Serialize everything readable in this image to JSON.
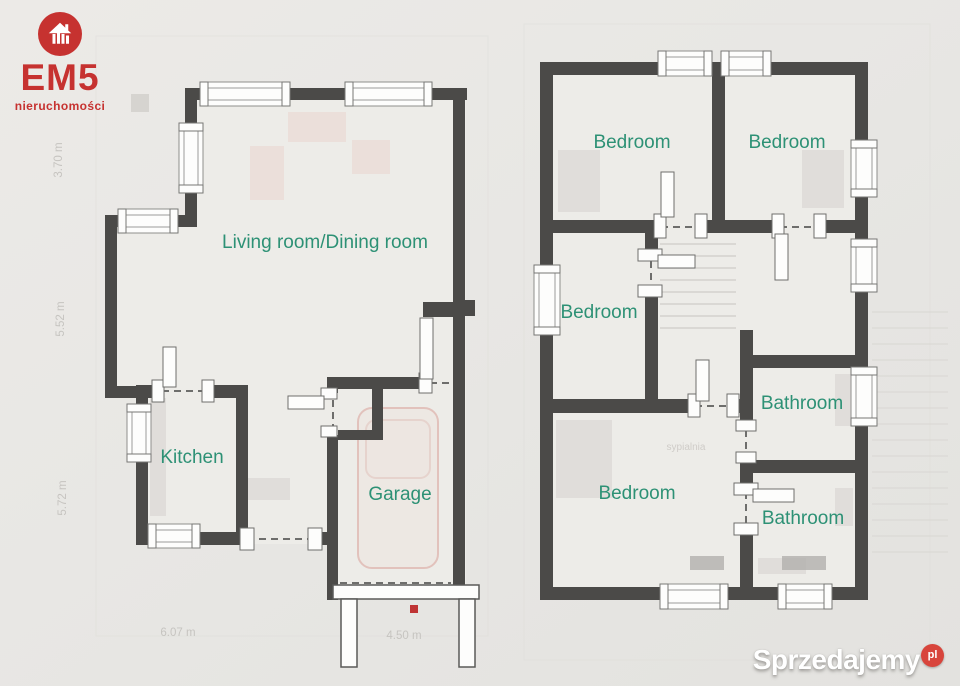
{
  "branding": {
    "logo_text": "EM5",
    "logo_subtext": "nieruchomości",
    "watermark_text": "Sprzedajemy",
    "watermark_tld": "pl"
  },
  "colors": {
    "wall": "#4b4a48",
    "room_label": "#2d9175",
    "brand_red": "#c63230",
    "watermark_red": "#d8453c",
    "accent_dot": "#bf3434"
  },
  "ground_floor": {
    "rooms": [
      {
        "label": "Living room/Dining room"
      },
      {
        "label": "Kitchen"
      },
      {
        "label": "Garage"
      }
    ]
  },
  "first_floor": {
    "rooms": [
      {
        "label": "Bedroom"
      },
      {
        "label": "Bedroom"
      },
      {
        "label": "Bedroom"
      },
      {
        "label": "Bedroom"
      },
      {
        "label": "Bathroom"
      },
      {
        "label": "Bathroom"
      }
    ]
  },
  "dimensions": {
    "left_side": [
      "3.70 m",
      "5.52 m",
      "5.72 m"
    ],
    "bottom": [
      "6.07 m",
      "4.50 m"
    ]
  },
  "background": {
    "faint_room_label": "sypialnia"
  }
}
